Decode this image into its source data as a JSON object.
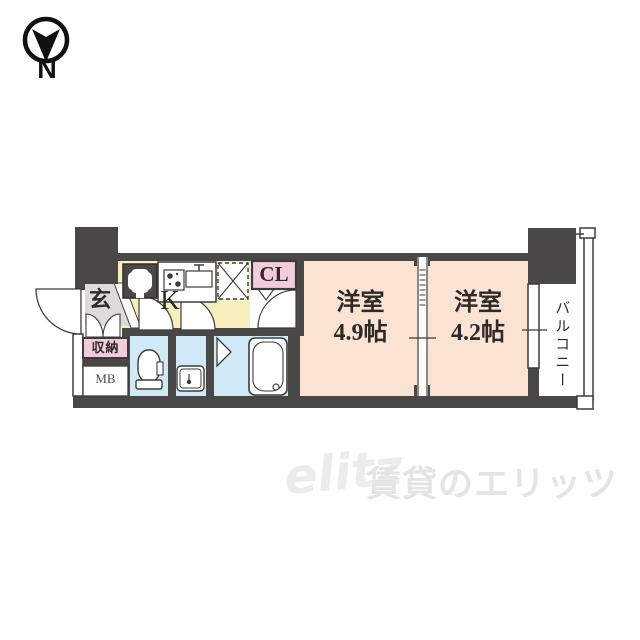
{
  "compass": {
    "label": "N"
  },
  "plan": {
    "entrance_label": "玄",
    "storage_label": "収納",
    "meter_box_label": "MB",
    "kitchen_label": "K",
    "closet_label": "CL",
    "room1": {
      "name": "洋室",
      "size": "4.9帖"
    },
    "room2": {
      "name": "洋室",
      "size": "4.2帖"
    },
    "balcony_label": "バルコニー"
  },
  "watermark": {
    "logo": "elitz",
    "brand": "賃貸のエリッツ"
  },
  "palette": {
    "wall": "#4a4846",
    "outline": "#3d3c3b",
    "room_floor": "#fae3d3",
    "kitchen_floor": "#f8efbf",
    "wet_area_floor": "#cfe9f7",
    "closet_bg": "#f2cbdc",
    "entrance_bg": "#dcdbd9",
    "watermark": "#e9e9e9"
  }
}
